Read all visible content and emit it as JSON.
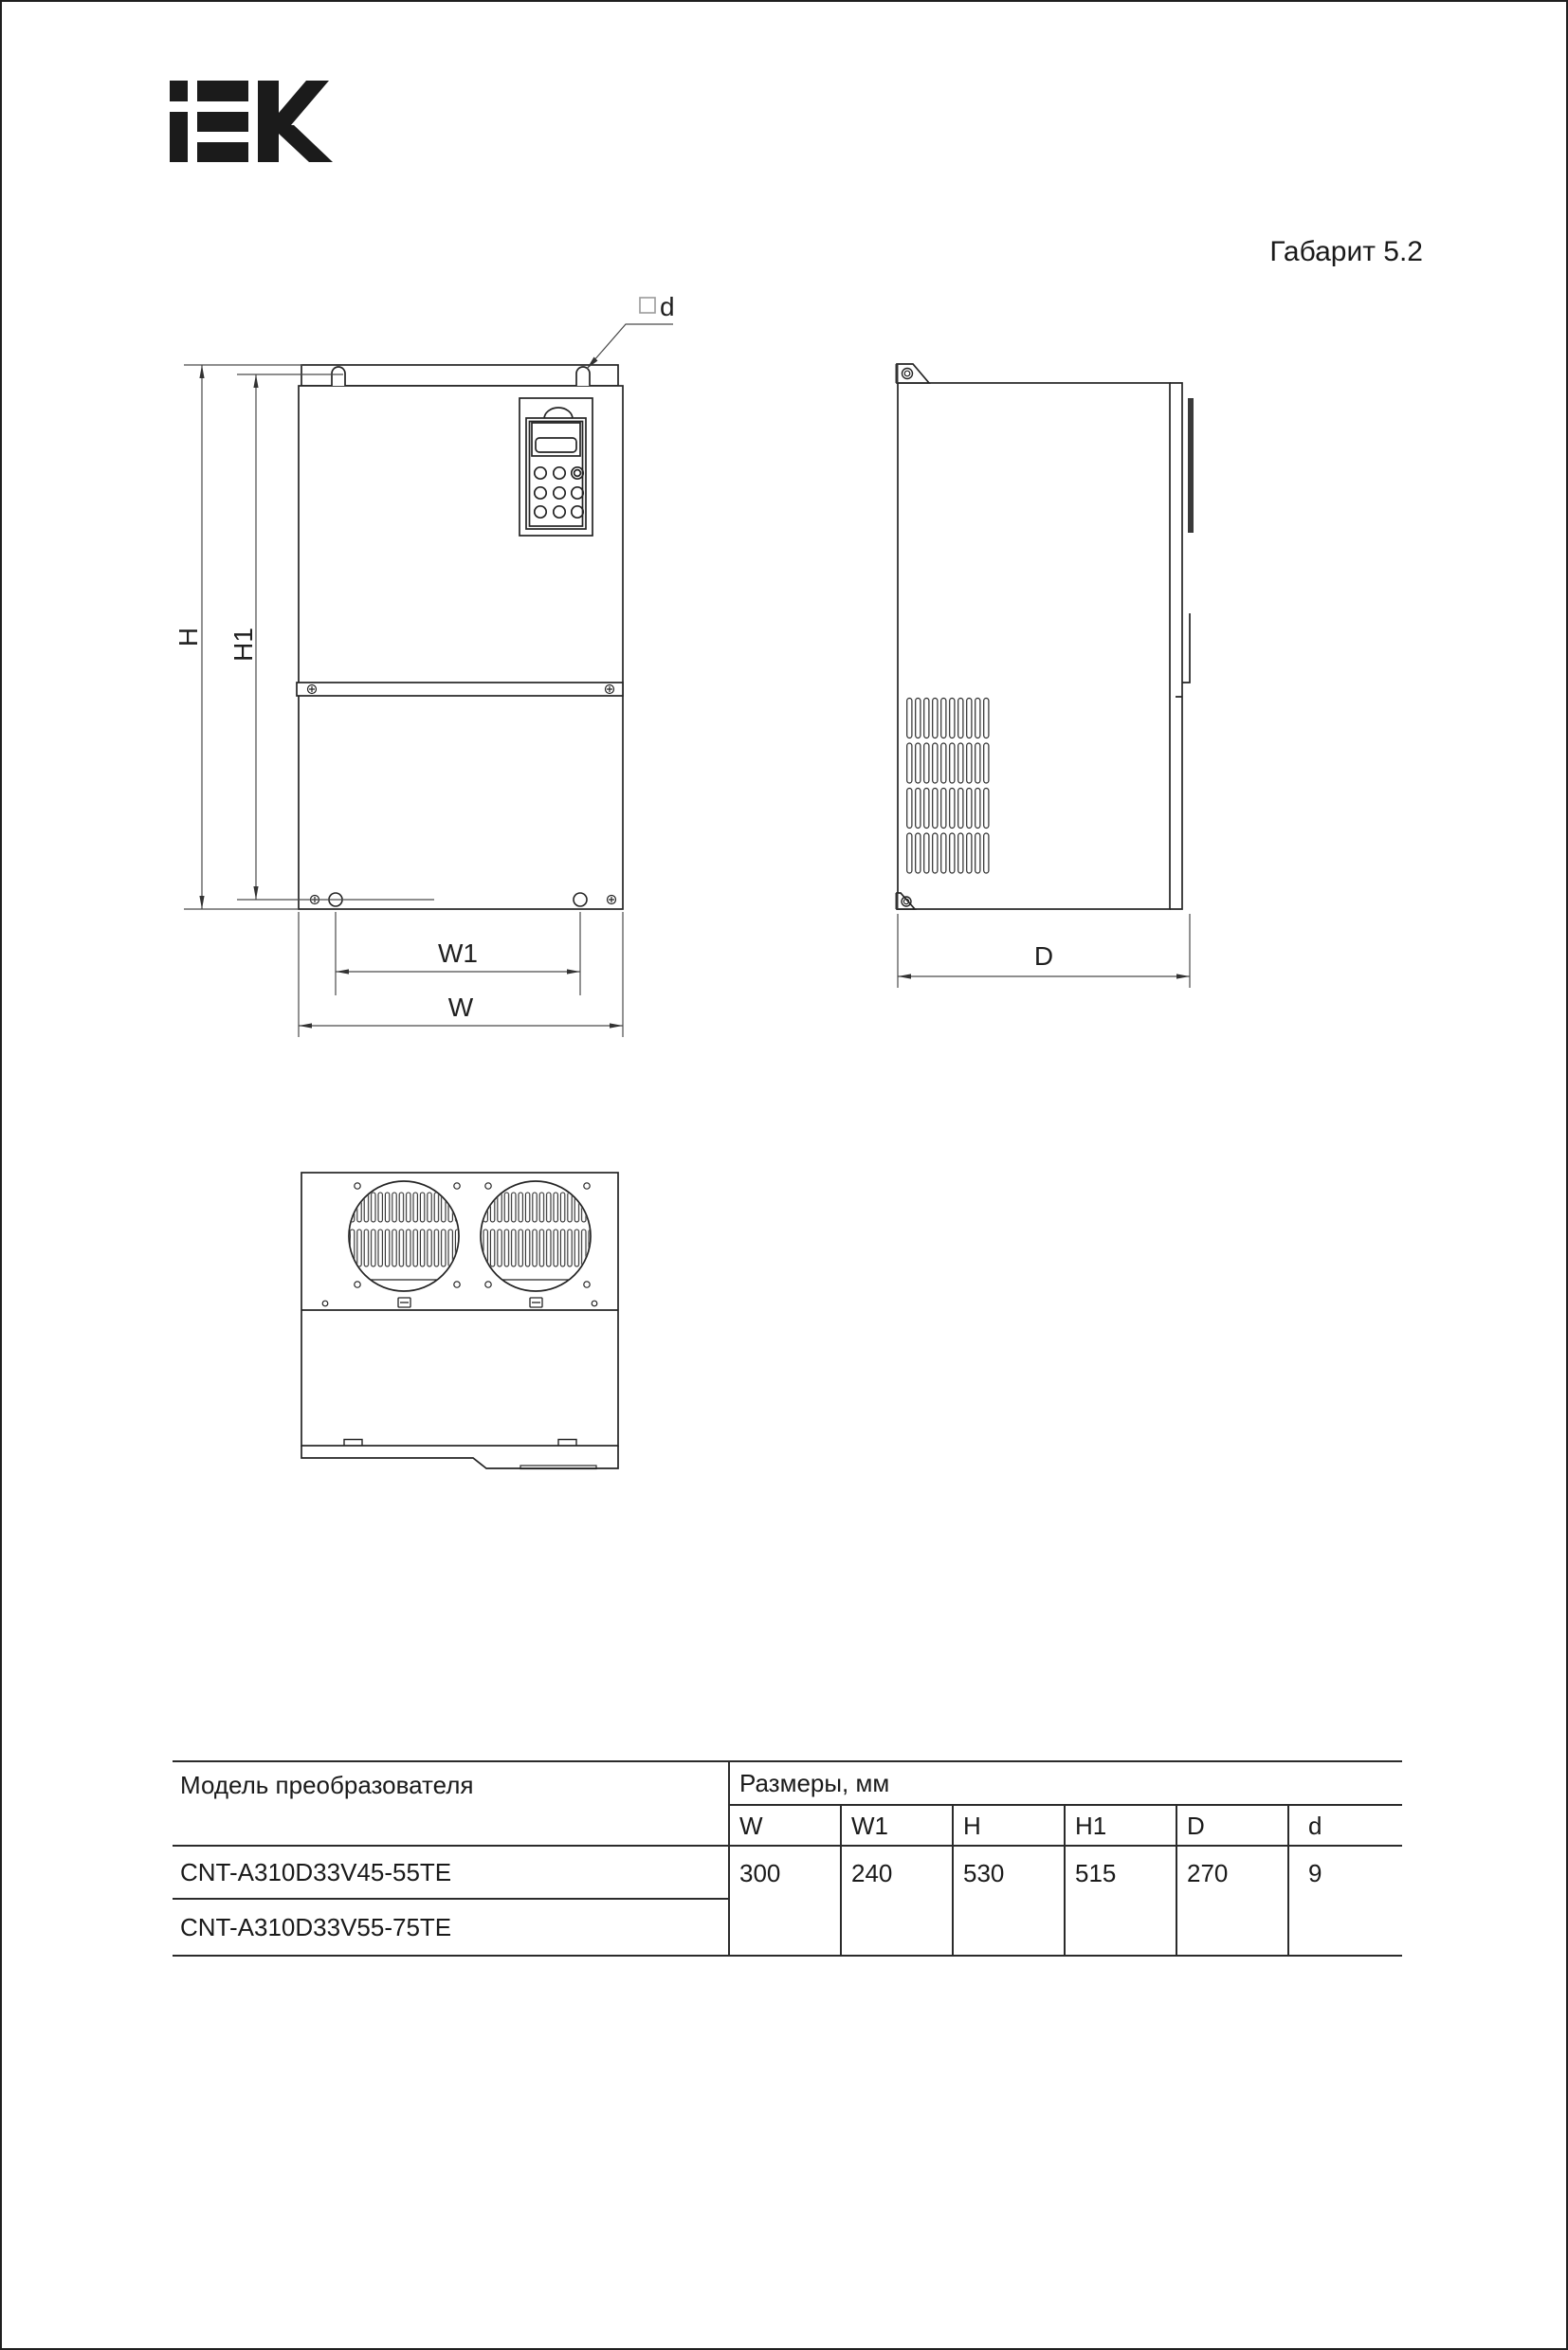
{
  "header": {
    "brand": "IEK",
    "sheet_label": "Габарит 5.2"
  },
  "drawing": {
    "labels": {
      "h": "H",
      "h1": "H1",
      "w1": "W1",
      "w": "W",
      "depth": "D",
      "hole_d": "d"
    }
  },
  "table": {
    "model_header": "Модель преобразователя",
    "dims_header": "Размеры, мм",
    "dim_cols": [
      "W",
      "W1",
      "H",
      "H1",
      "D",
      "d"
    ],
    "rows": [
      {
        "model": "CNT-A310D33V45-55TE"
      },
      {
        "model": "CNT-A310D33V55-75TE"
      }
    ],
    "values": [
      "300",
      "240",
      "530",
      "515",
      "270",
      "9"
    ]
  }
}
